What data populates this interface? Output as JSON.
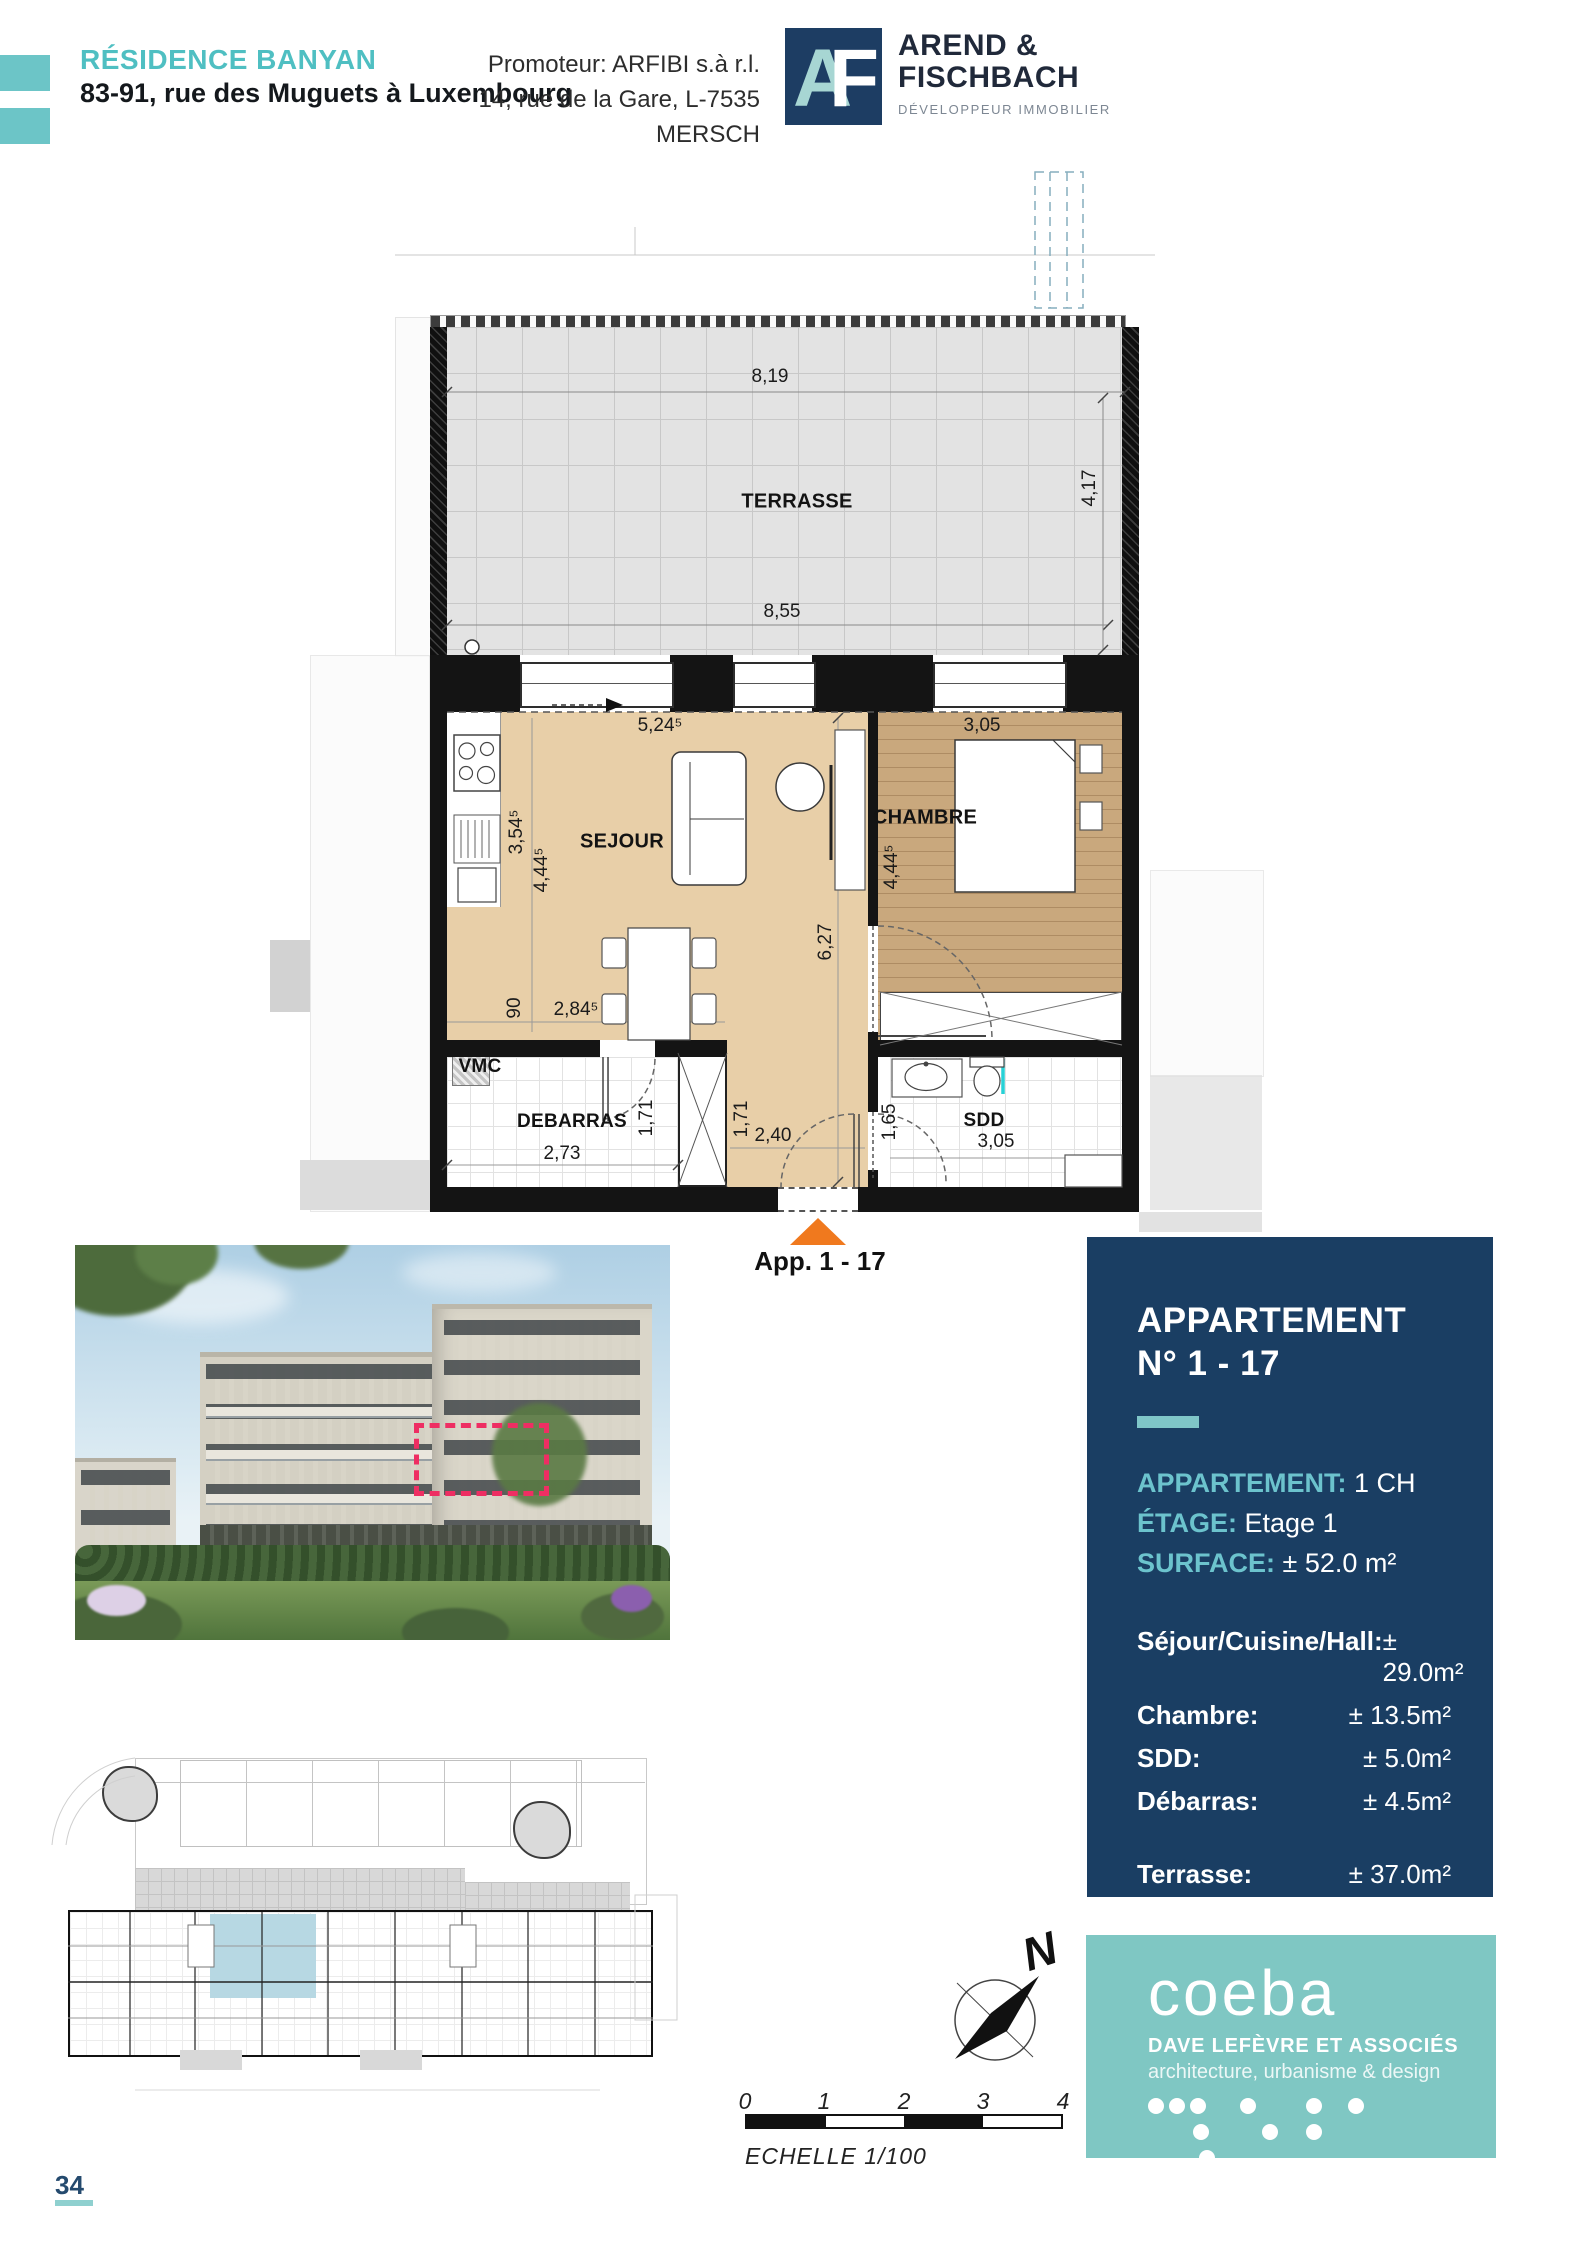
{
  "header": {
    "project_name": "RÉSIDENCE BANYAN",
    "project_address": "83-91, rue des Muguets à Luxembourg",
    "promoter_line1": "Promoteur: ARFIBI s.à r.l.",
    "promoter_line2": "14, rue de la Gare, L-7535 MERSCH",
    "logo": {
      "monogram_a": "A",
      "monogram_f": "F",
      "name_line1": "AREND &",
      "name_line2": "FISCHBACH",
      "tagline": "DÉVELOPPEUR IMMOBILIER"
    }
  },
  "floor_plan": {
    "rooms": {
      "terrasse": "TERRASSE",
      "sejour": "SEJOUR",
      "chambre": "CHAMBRE",
      "debarras": "DEBARRAS",
      "sdd": "SDD",
      "vmc": "VMC"
    },
    "dimensions": {
      "terrace_width_top": "8,19",
      "terrace_depth": "4,17",
      "terrace_width_inner": "8,55",
      "sejour_width": "5,24⁵",
      "chambre_width_top": "3,05",
      "kitchen_depth": "3,54⁵",
      "sejour_depth": "4,44⁵",
      "chambre_depth": "4,44⁵",
      "apartment_depth": "6,27",
      "kitchen_width": "90",
      "sejour_bottom": "2,84⁵",
      "debarras_width": "2,73",
      "debarras_depth": "1,71",
      "hall_depth": "1,71",
      "hall_width": "2,40",
      "sdd_depth": "1,65",
      "sdd_width": "3,05"
    },
    "entry_label": "App. 1 - 17"
  },
  "info_panel": {
    "title_line1": "APPARTEMENT",
    "title_line2": "N° 1 - 17",
    "specs": [
      {
        "label": "APPARTEMENT:",
        "value": "1 CH"
      },
      {
        "label": "ÉTAGE:",
        "value": "Etage 1"
      },
      {
        "label": "SURFACE:",
        "value": "± 52.0 m²"
      }
    ],
    "areas": [
      {
        "label": "Séjour/Cuisine/Hall:",
        "value": "± 29.0m²"
      },
      {
        "label": "Chambre:",
        "value": "± 13.5m²"
      },
      {
        "label": "SDD:",
        "value": "± 5.0m²"
      },
      {
        "label": "Débarras:",
        "value": "± 4.5m²"
      }
    ],
    "terrace": {
      "label": "Terrasse:",
      "value": "± 37.0m²"
    }
  },
  "compass": {
    "north": "N"
  },
  "scale_bar": {
    "ticks": [
      "0",
      "1",
      "2",
      "3",
      "4"
    ],
    "caption": "ECHELLE  1/100"
  },
  "architect": {
    "brand": "coeba",
    "subtitle": "DAVE LEFÈVRE ET ASSOCIÉS",
    "tagline": "architecture, urbanisme & design"
  },
  "page": {
    "number": "34"
  },
  "colors": {
    "accent_teal": "#5ec1c2",
    "panel_navy": "#1a3e63",
    "coeba_teal": "#7fc7c3",
    "highlight_pink": "#ee2e63",
    "arrow_orange": "#f0791e"
  }
}
